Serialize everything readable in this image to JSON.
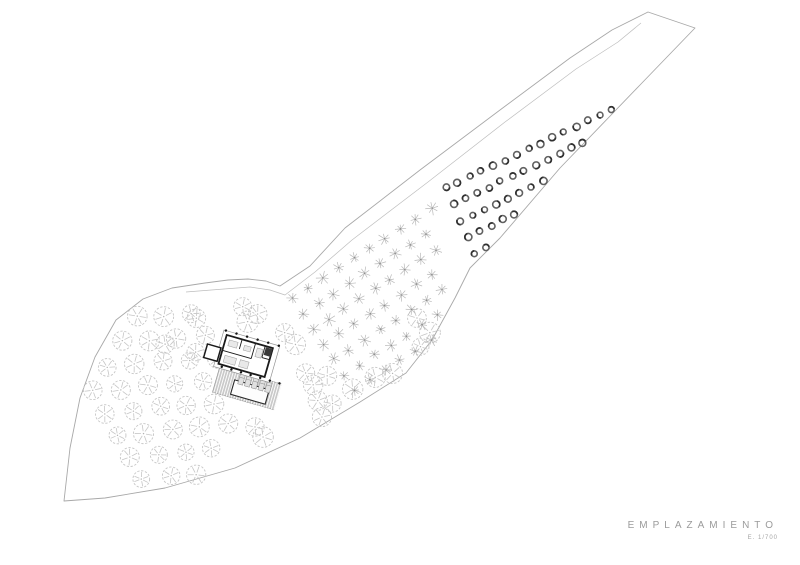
{
  "title_block": {
    "title": "EMPLAZAMIENTO",
    "scale_label": "E. 1/700"
  },
  "colors": {
    "paper": "#ffffff",
    "boundary": "#a8a8a8",
    "path": "#bdbdbd",
    "olive_tree": "#c6c6c6",
    "orchard_tree": "#b9b9b9",
    "dark_tree_ring": "#616161",
    "dark_tree_shade": "#303030",
    "wall": "#1a1a1a",
    "canopy": "#949494",
    "terrace": "#c9c9c9",
    "furniture": "#e9e9e9",
    "dot": "#161616"
  },
  "plan": {
    "boundary": [
      [
        648,
        12
      ],
      [
        695,
        28
      ],
      [
        640,
        85
      ],
      [
        560,
        168
      ],
      [
        500,
        238
      ],
      [
        470,
        268
      ],
      [
        455,
        298
      ],
      [
        432,
        340
      ],
      [
        406,
        373
      ],
      [
        360,
        402
      ],
      [
        300,
        438
      ],
      [
        235,
        468
      ],
      [
        165,
        488
      ],
      [
        105,
        498
      ],
      [
        64,
        501
      ],
      [
        70,
        448
      ],
      [
        80,
        398
      ],
      [
        95,
        357
      ],
      [
        116,
        320
      ],
      [
        143,
        299
      ],
      [
        172,
        288
      ],
      [
        205,
        283
      ],
      [
        228,
        280
      ],
      [
        248,
        279
      ],
      [
        266,
        281
      ],
      [
        280,
        286
      ],
      [
        310,
        266
      ],
      [
        345,
        228
      ],
      [
        420,
        170
      ],
      [
        500,
        110
      ],
      [
        570,
        58
      ],
      [
        612,
        30
      ]
    ],
    "inner_path": [
      [
        186,
        292
      ],
      [
        224,
        289
      ],
      [
        250,
        287
      ],
      [
        270,
        290
      ],
      [
        285,
        295
      ],
      [
        315,
        272
      ],
      [
        352,
        240
      ],
      [
        428,
        182
      ],
      [
        505,
        122
      ],
      [
        576,
        69
      ],
      [
        618,
        42
      ],
      [
        641,
        23
      ]
    ],
    "fields": [
      {
        "name": "olive-grove-west",
        "type": "olive",
        "origin": [
          55,
          325
        ],
        "u": [
          27.5,
          -2.5
        ],
        "v": [
          12.5,
          22
        ],
        "nu": 8,
        "nv": 9,
        "r": 9,
        "jitter": 1.8,
        "clip": {
          "a": [
            210,
            280
          ],
          "b": [
            250,
            505
          ],
          "keep": "pos"
        }
      },
      {
        "name": "olive-scatter",
        "type": "olive",
        "r": 9.5,
        "jitter": 0.8,
        "points": [
          [
            243,
            307
          ],
          [
            257,
            314
          ],
          [
            247,
            322
          ],
          [
            196,
            318
          ],
          [
            165,
            344
          ],
          [
            196,
            352
          ],
          [
            284,
            332
          ],
          [
            295,
            344
          ],
          [
            305,
            373
          ],
          [
            327,
            376
          ],
          [
            313,
            385
          ],
          [
            375,
            378
          ],
          [
            393,
            374
          ],
          [
            381,
            388
          ],
          [
            318,
            400
          ],
          [
            333,
            403
          ],
          [
            322,
            417
          ],
          [
            255,
            427
          ],
          [
            263,
            437
          ],
          [
            417,
            318
          ],
          [
            430,
            332
          ],
          [
            421,
            347
          ],
          [
            352,
            389
          ]
        ]
      },
      {
        "name": "orchard-grid",
        "type": "star",
        "origin": [
          293,
          298
        ],
        "u": [
          15.4,
          -9.9
        ],
        "v": [
          10.2,
          15.4
        ],
        "nu": 12,
        "nv": 9,
        "r": 6,
        "jitter": 1.1,
        "clip": {
          "a": [
            448,
            320
          ],
          "b": [
            434,
            150
          ],
          "keep": "neg"
        }
      },
      {
        "name": "vineyard-band",
        "type": "dark",
        "origin": [
          446,
          188
        ],
        "u": [
          11.8,
          -5.6
        ],
        "v": [
          7.2,
          16.2
        ],
        "nu": 23,
        "nv": 7,
        "r": 3.2,
        "jitter": 1.0,
        "clip": {
          "a": [
            434,
            320
          ],
          "b": [
            420,
            150
          ],
          "keep": "pos"
        }
      }
    ],
    "building": {
      "translate": [
        224,
        330
      ],
      "rotate": 16,
      "canopy": {
        "x": 0,
        "y": 0,
        "w": 58,
        "h": 38
      },
      "house": {
        "x": 4,
        "y": 4,
        "w": 48,
        "h": 30
      },
      "annex": {
        "x": -12,
        "y": 18,
        "w": 14,
        "h": 14
      },
      "terrace": {
        "x": 6,
        "y": 36,
        "w": 64,
        "h": 27,
        "stripe_step": 2.6
      },
      "pool": {
        "x": 24,
        "y": 45,
        "w": 36,
        "h": 15
      },
      "walls": [
        [
          34,
          4,
          34,
          20
        ],
        [
          4,
          20,
          34,
          20
        ],
        [
          44,
          4,
          44,
          16
        ],
        [
          44,
          16,
          52,
          16
        ],
        [
          20,
          4,
          20,
          14
        ]
      ],
      "furniture": [
        [
          8,
          8,
          9,
          6
        ],
        [
          8,
          24,
          12,
          7
        ],
        [
          24,
          24,
          9,
          7
        ],
        [
          37,
          8,
          6,
          9
        ],
        [
          24,
          9,
          7,
          5
        ]
      ],
      "dark_room": {
        "x": 45,
        "y": 5,
        "w": 7,
        "h": 8
      },
      "chairs": {
        "y": 38,
        "x0": 28,
        "step": 7,
        "n": 5,
        "w": 5,
        "h": 10
      },
      "dots": [
        {
          "y": 0,
          "xs": [
            2,
            13,
            24,
            35,
            46,
            57
          ]
        },
        {
          "y": 36,
          "xs": [
            8,
            18,
            28,
            38,
            48,
            58,
            68
          ]
        }
      ]
    }
  }
}
